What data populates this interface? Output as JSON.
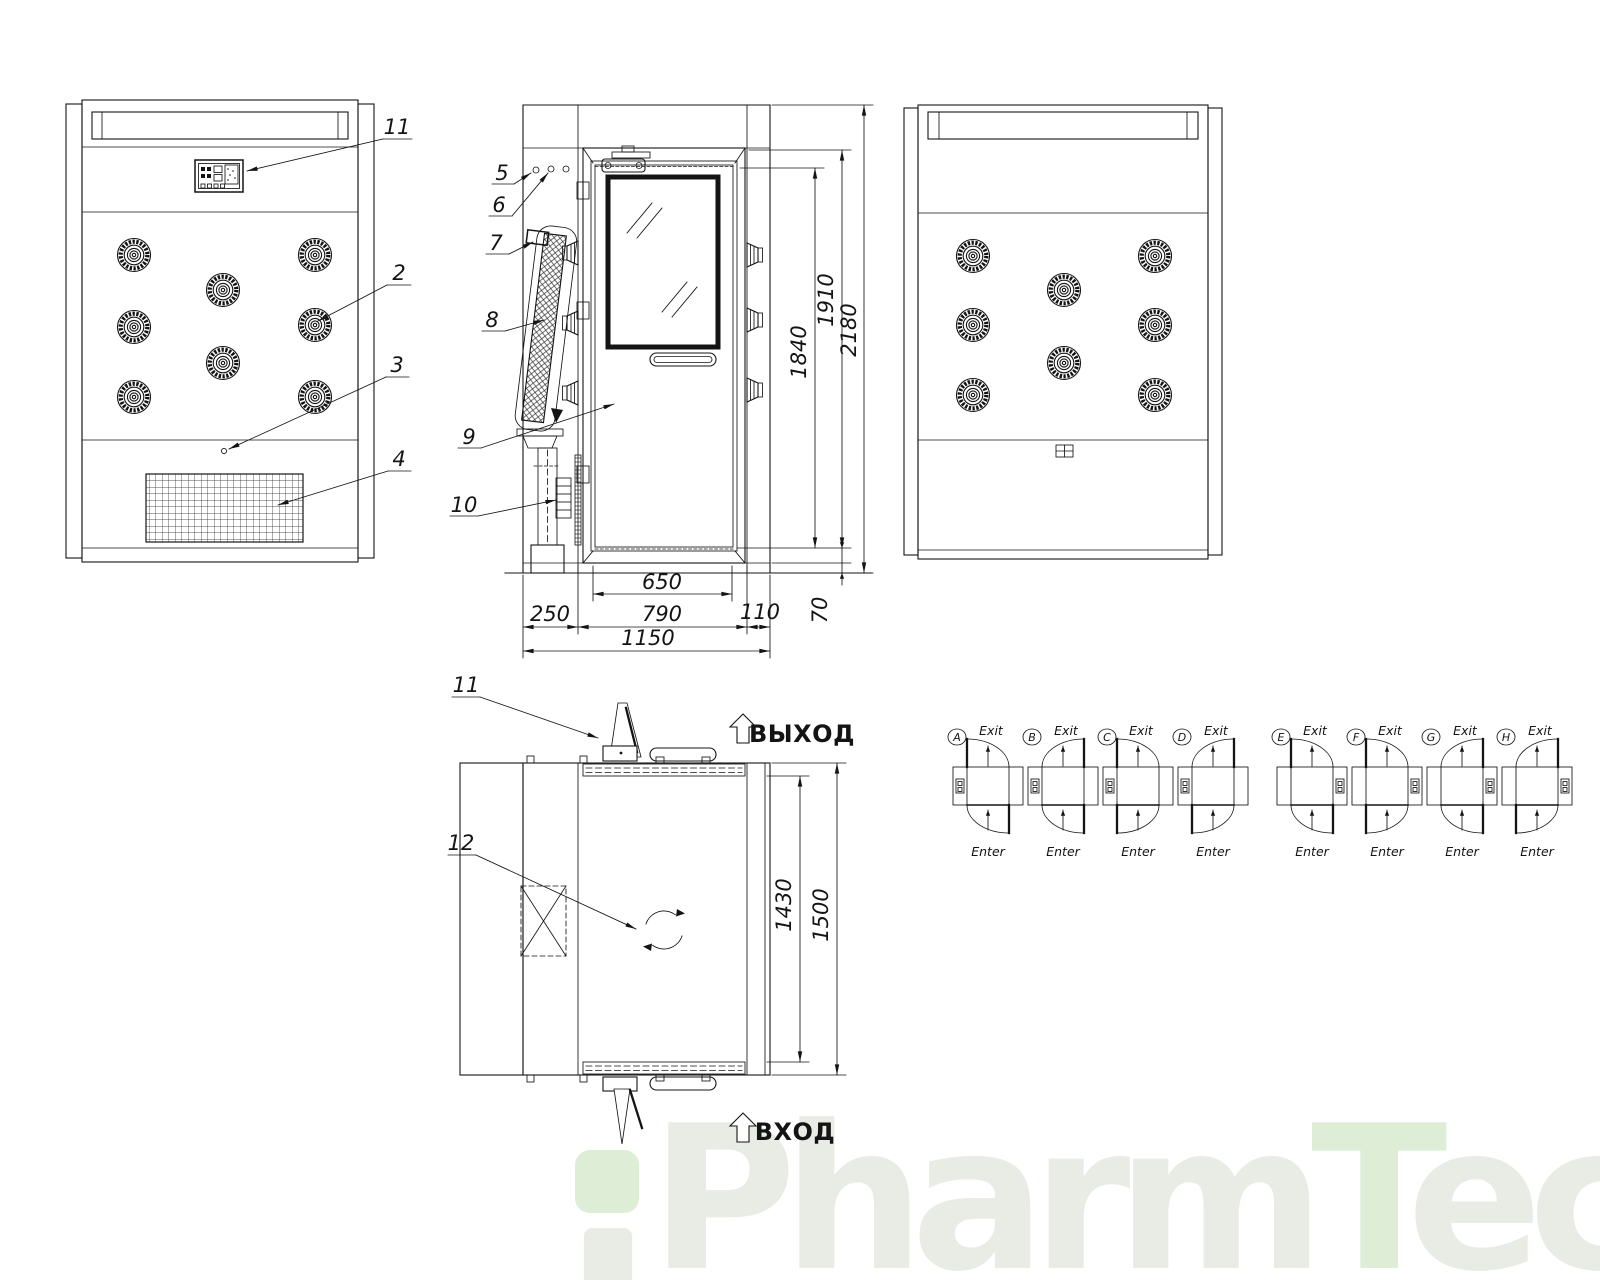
{
  "front_view": {
    "callout_11": "11",
    "callout_2": "2",
    "callout_3": "3",
    "callout_4": "4"
  },
  "side_view": {
    "callout_5": "5",
    "callout_6": "6",
    "callout_7": "7",
    "callout_8": "8",
    "callout_9": "9",
    "callout_10": "10",
    "dim_1840": "1840",
    "dim_1910": "1910",
    "dim_2180": "2180",
    "dim_70": "70",
    "dim_650": "650",
    "dim_250": "250",
    "dim_790": "790",
    "dim_110": "110",
    "dim_1150": "1150"
  },
  "plan_view": {
    "callout_11": "11",
    "callout_12": "12",
    "dim_1430": "1430",
    "dim_1500": "1500",
    "exit_text": "ВЫХОД",
    "enter_text": "ВХОД"
  },
  "variants": {
    "exit_label": "Exit",
    "enter_label": "Enter",
    "items": [
      {
        "letter": "A",
        "box_side": "left",
        "exit_hinge": "left",
        "enter_hinge": "right"
      },
      {
        "letter": "B",
        "box_side": "left",
        "exit_hinge": "right",
        "enter_hinge": "right"
      },
      {
        "letter": "C",
        "box_side": "left",
        "exit_hinge": "left",
        "enter_hinge": "left"
      },
      {
        "letter": "D",
        "box_side": "left",
        "exit_hinge": "right",
        "enter_hinge": "left"
      },
      {
        "letter": "E",
        "box_side": "right",
        "exit_hinge": "left",
        "enter_hinge": "right"
      },
      {
        "letter": "F",
        "box_side": "right",
        "exit_hinge": "left",
        "enter_hinge": "left"
      },
      {
        "letter": "G",
        "box_side": "right",
        "exit_hinge": "right",
        "enter_hinge": "right"
      },
      {
        "letter": "H",
        "box_side": "right",
        "exit_hinge": "right",
        "enter_hinge": "left"
      }
    ]
  },
  "watermark": {
    "part_pharm": "Pharm",
    "part_t": "T",
    "part_ech": "ech",
    "gray_color": "#e9ebe5",
    "green_color": "#ddedd6"
  }
}
